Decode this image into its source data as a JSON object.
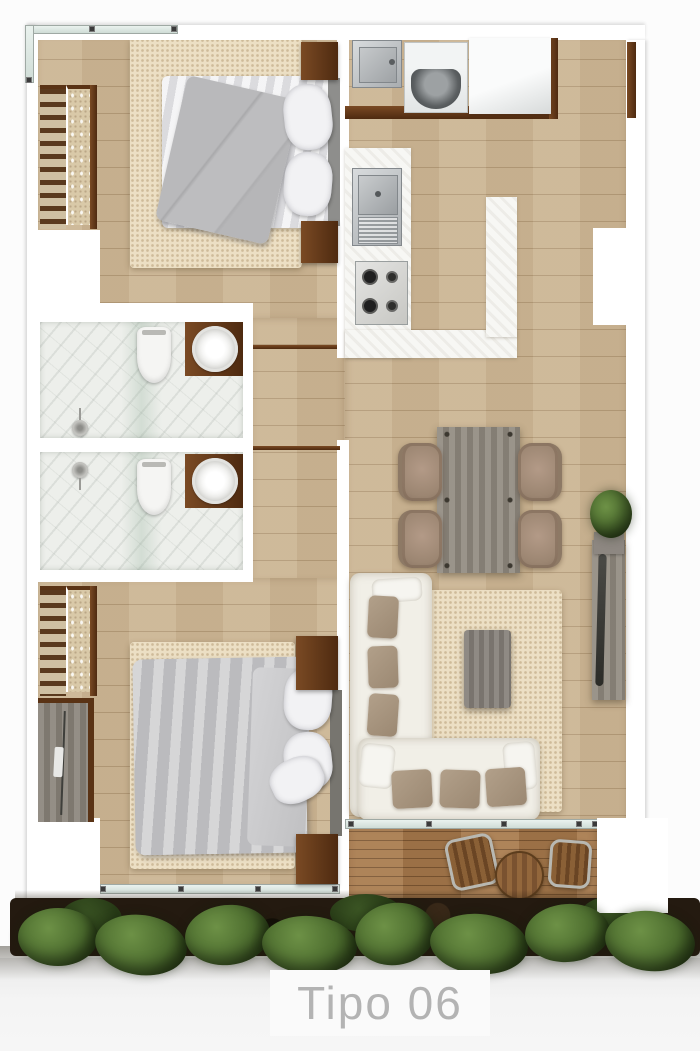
{
  "title": {
    "label": "Tipo 06"
  },
  "palette": {
    "background": "#fcfcfc",
    "wall_white": "#ffffff",
    "wood_floor": "#ccb695",
    "deck_wood": "#a97c4f",
    "accent_dark_wood": "#5f3317",
    "marble": "#edefeb",
    "rug_cream": "#ecdfc4",
    "furniture_gray": "#90897f",
    "sofa_white": "#f1efe7",
    "cushion_taupe": "#a69480",
    "chair_taupe": "#a58d7d",
    "bed_gray": "#c2c2c4",
    "plant_green": "#4c6c2e",
    "soil_dark": "#241a10",
    "glass_teal": "#d7e5df",
    "title_text": "#b3b3b3"
  },
  "legend": {
    "rooms": [
      "bedroom-1",
      "bathroom-1",
      "bathroom-2",
      "bedroom-2",
      "kitchen",
      "dining-area",
      "living-area",
      "hallway",
      "balcony",
      "garden-strip"
    ],
    "furniture": [
      "double-bed",
      "nightstand",
      "closet-shelves",
      "wardrobe",
      "area-rug",
      "toilet",
      "round-basin",
      "shower-head",
      "laundry-sink",
      "washing-machine",
      "kitchen-counter",
      "kitchen-sink",
      "stove-4-burners",
      "dining-table",
      "dining-chair",
      "l-shaped-sofa",
      "coffee-table",
      "tv-console",
      "potted-plant",
      "lounge-chair",
      "bistro-table",
      "shrub"
    ]
  }
}
